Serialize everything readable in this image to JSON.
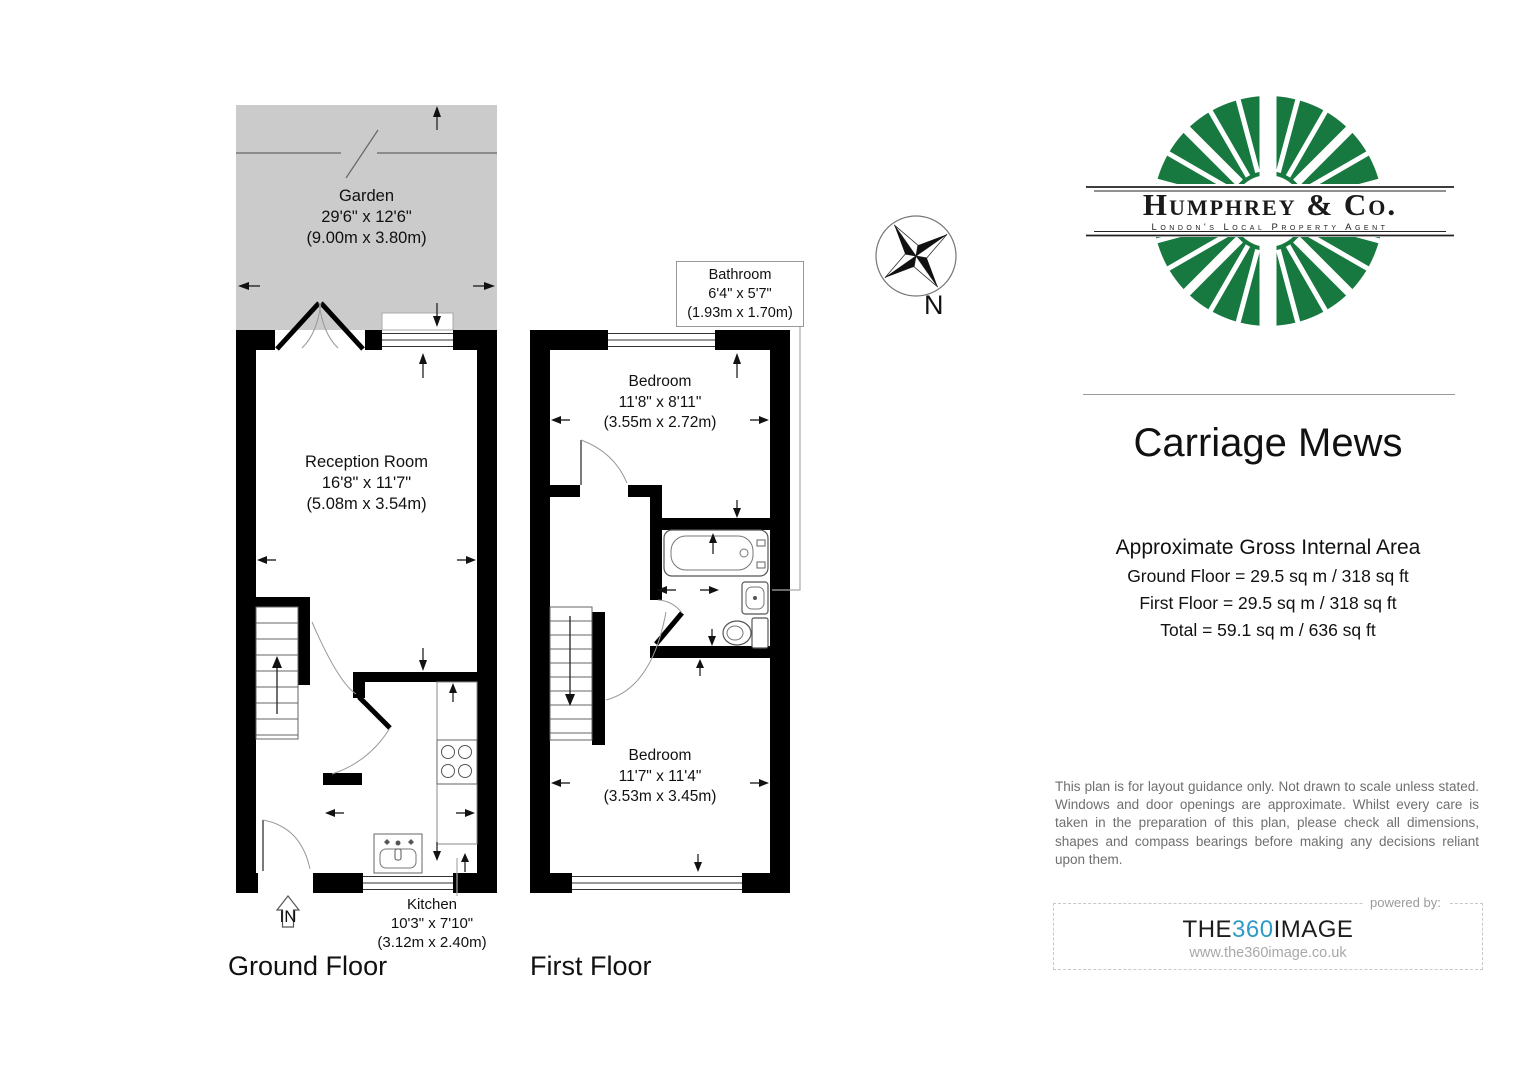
{
  "colors": {
    "logo_green": "#17793f",
    "garden_gray": "#cbcbcb",
    "wall_black": "#000000",
    "brand360_blue": "#2e9bc6",
    "muted_text_gray": "#6f6f6f"
  },
  "ground_floor": {
    "floor_label": "Ground Floor",
    "entrance_label": "IN",
    "garden": {
      "name": "Garden",
      "imperial": "29'6\" x 12'6\"",
      "metric": "(9.00m x 3.80m)"
    },
    "reception": {
      "name": "Reception Room",
      "imperial": "16'8\" x 11'7\"",
      "metric": "(5.08m x 3.54m)"
    },
    "kitchen": {
      "name": "Kitchen",
      "imperial": "10'3\" x 7'10\"",
      "metric": "(3.12m x 2.40m)"
    }
  },
  "first_floor": {
    "floor_label": "First Floor",
    "bathroom": {
      "name": "Bathroom",
      "imperial": "6'4\" x 5'7\"",
      "metric": "(1.93m x 1.70m)"
    },
    "bedroom_front": {
      "name": "Bedroom",
      "imperial": "11'8\" x 8'11\"",
      "metric": "(3.55m x 2.72m)"
    },
    "bedroom_back": {
      "name": "Bedroom",
      "imperial": "11'7\" x 11'4\"",
      "metric": "(3.53m x 3.45m)"
    }
  },
  "compass": {
    "north_label": "N"
  },
  "sidebar": {
    "brand": {
      "name": "Humphrey & Co.",
      "tagline": "London's Local Property Agent"
    },
    "property_title": "Carriage Mews",
    "area": {
      "heading": "Approximate Gross Internal Area",
      "lines": [
        "Ground Floor = 29.5 sq m / 318 sq ft",
        "First Floor = 29.5 sq m / 318 sq ft",
        "Total = 59.1 sq m / 636 sq ft"
      ]
    },
    "disclaimer": "This plan is for layout guidance only. Not drawn to scale unless stated. Windows and door openings are approximate. Whilst every care is taken in the preparation of this plan, please check all dimensions, shapes and compass bearings before making any decisions reliant upon them.",
    "powered_by": {
      "label": "powered by:",
      "brand_prefix": "THE",
      "brand_mid": "360",
      "brand_suffix": "IMAGE",
      "website": "www.the360image.co.uk"
    }
  }
}
